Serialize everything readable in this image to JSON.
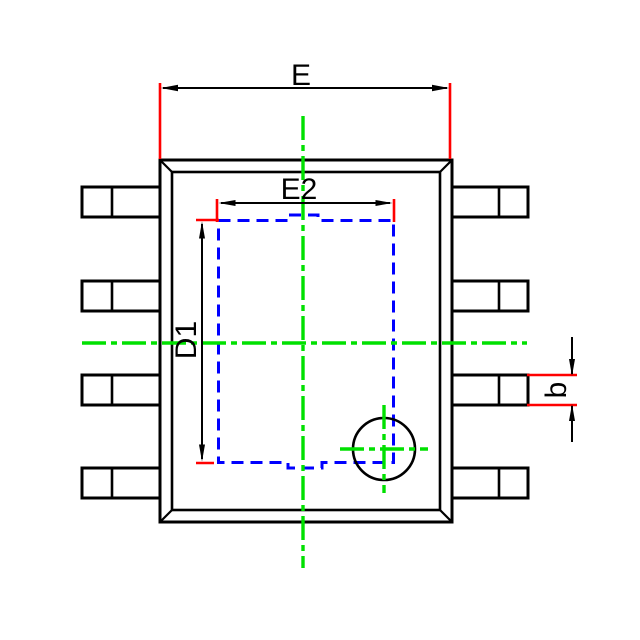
{
  "drawing": {
    "kind": "IC package outline dimension drawing, 8-lead SOP top view",
    "dimensions": {
      "overall_width_label": "E",
      "pad_width_label": "E2",
      "pad_length_label": "D1",
      "lead_width_label": "b"
    },
    "features": {
      "lead_count": 8,
      "leads_per_side": 4,
      "exposed_pad_outline": "blue dashed rectangle with small tabs at top and bottom center",
      "pin1_marker": "circle with green crosshair at bottom-right of exposed pad"
    },
    "colors": {
      "outline": "#000000",
      "dimension_extension": "#ff0000",
      "centerline": "#00e000",
      "exposed_pad": "#0000ff",
      "background": "#ffffff"
    }
  }
}
